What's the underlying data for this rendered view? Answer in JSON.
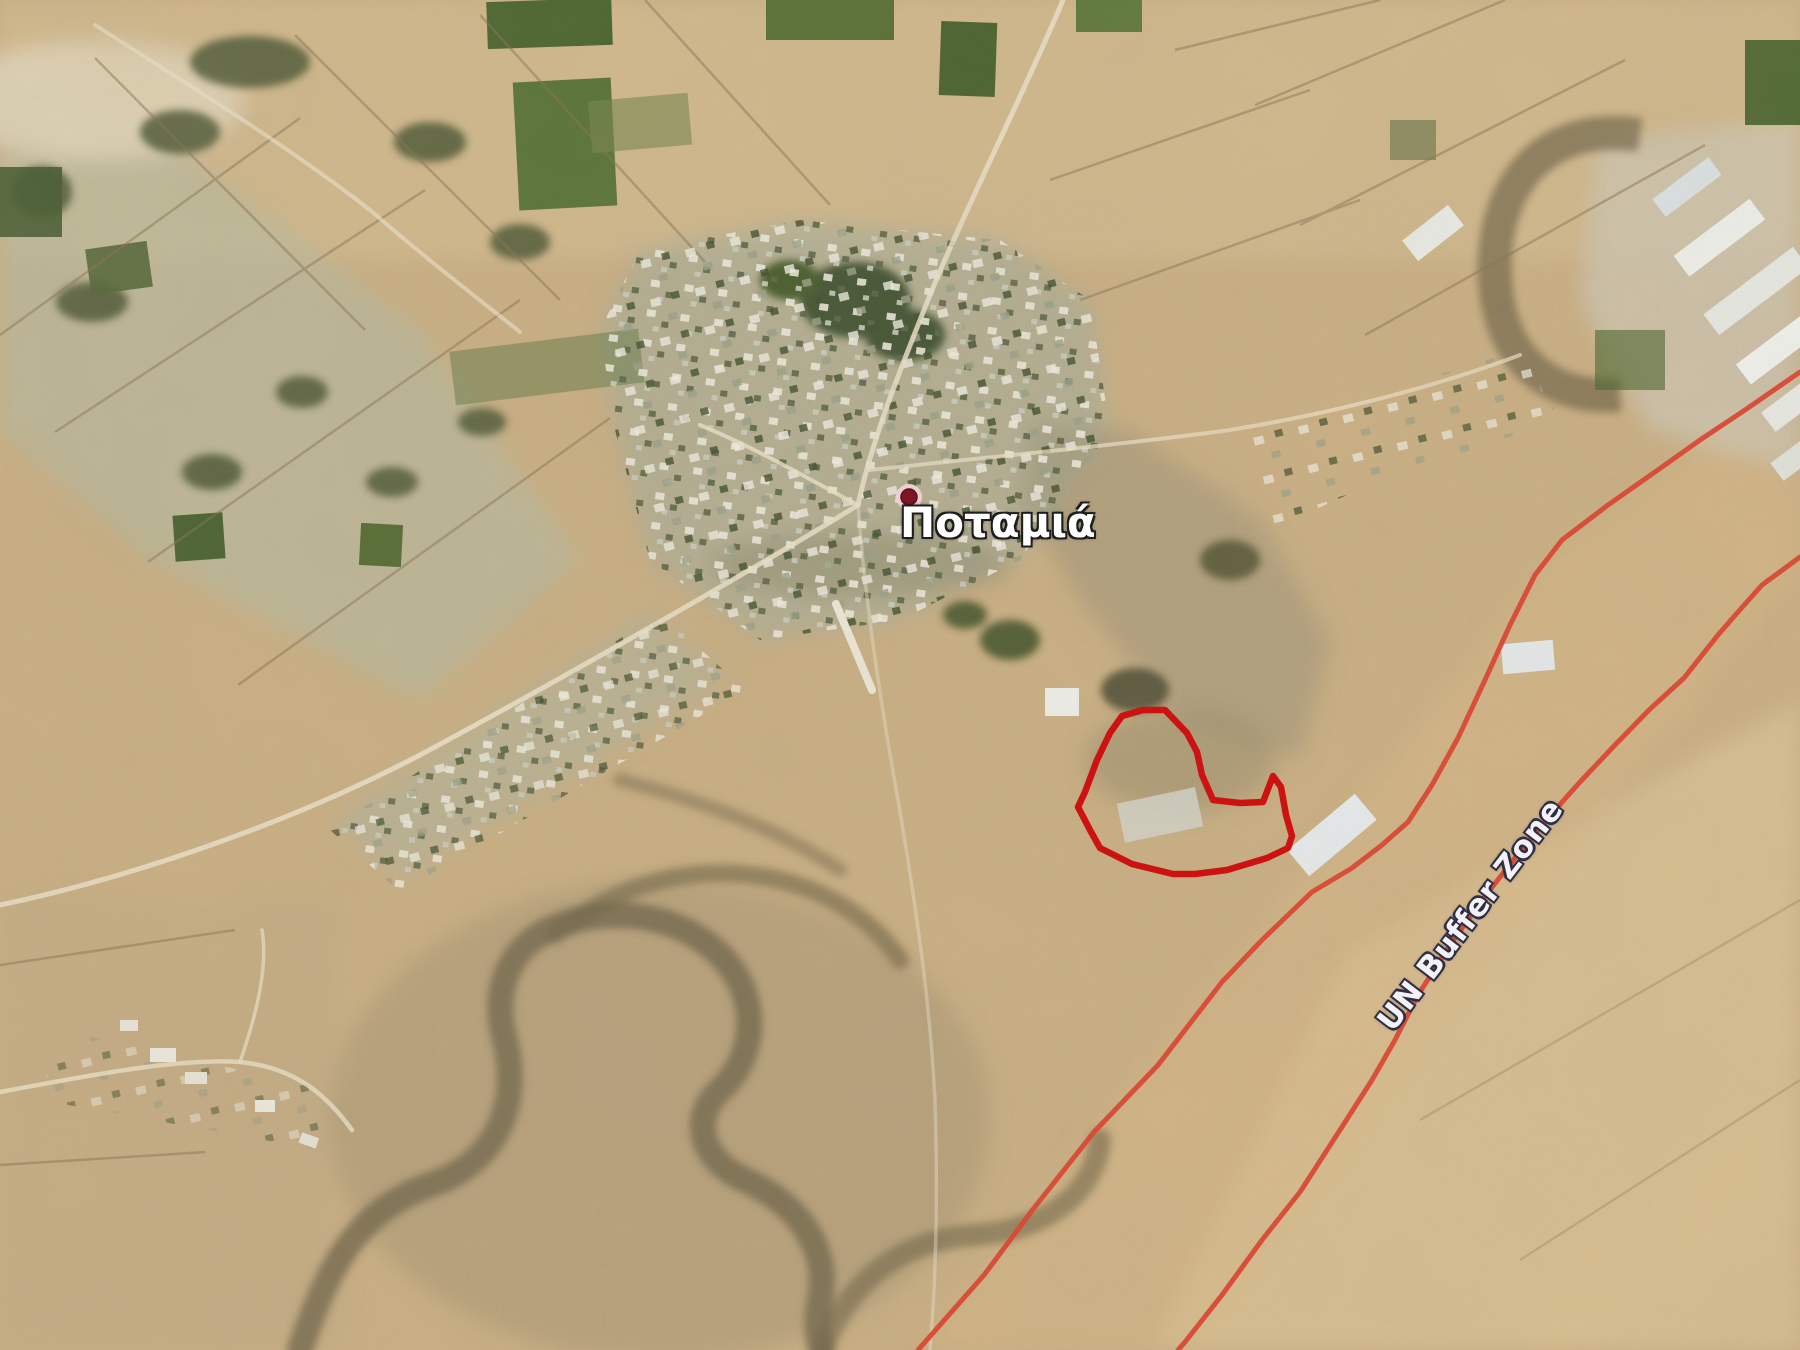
{
  "title": "Satellite map of Potamia village with UN Buffer Zone and red parcel outline",
  "map": {
    "width": 1800,
    "height": 1350,
    "place_marker": {
      "label": "Ποταμιά",
      "x": 909,
      "y": 497,
      "label_x": 900,
      "label_y": 500,
      "label_font_size": 42,
      "dot_radius": 8,
      "dot_ring_radius": 13,
      "dot_color": "#7d1526",
      "dot_ring_color": "#eccfcf",
      "label_color": "#ffffff",
      "label_outline_color": "#1e1e1e"
    },
    "buffer_zone_label": {
      "text": "UN Buffer Zone",
      "x": 1399,
      "y": 1038,
      "rotation_deg": -52.5,
      "font_size": 31,
      "color": "#f2f2f8",
      "outline_color": "#2e2e44"
    },
    "parcel_outline": {
      "color": "#cd1212",
      "stroke_width": 6.5,
      "points": [
        [
          1122,
          716
        ],
        [
          1143,
          710
        ],
        [
          1165,
          710
        ],
        [
          1187,
          733
        ],
        [
          1197,
          752
        ],
        [
          1202,
          775
        ],
        [
          1213,
          800
        ],
        [
          1240,
          803
        ],
        [
          1263,
          802
        ],
        [
          1273,
          776
        ],
        [
          1281,
          787
        ],
        [
          1286,
          815
        ],
        [
          1292,
          836
        ],
        [
          1288,
          848
        ],
        [
          1267,
          858
        ],
        [
          1227,
          870
        ],
        [
          1195,
          874
        ],
        [
          1173,
          874
        ],
        [
          1132,
          864
        ],
        [
          1100,
          848
        ],
        [
          1090,
          830
        ],
        [
          1078,
          807
        ],
        [
          1085,
          792
        ],
        [
          1097,
          760
        ],
        [
          1110,
          733
        ]
      ]
    },
    "boundary_lines": {
      "color": "#d84a36",
      "stroke_width": 5,
      "lines": [
        [
          [
            1800,
            372
          ],
          [
            1745,
            410
          ],
          [
            1700,
            440
          ],
          [
            1655,
            472
          ],
          [
            1608,
            505
          ],
          [
            1562,
            540
          ],
          [
            1535,
            575
          ],
          [
            1510,
            625
          ],
          [
            1485,
            680
          ],
          [
            1458,
            738
          ],
          [
            1432,
            785
          ],
          [
            1408,
            822
          ],
          [
            1382,
            845
          ],
          [
            1352,
            868
          ],
          [
            1312,
            892
          ],
          [
            1262,
            940
          ],
          [
            1222,
            982
          ],
          [
            1158,
            1065
          ],
          [
            1094,
            1132
          ],
          [
            1034,
            1208
          ],
          [
            984,
            1275
          ],
          [
            918,
            1350
          ]
        ],
        [
          [
            1800,
            557
          ],
          [
            1762,
            585
          ],
          [
            1738,
            612
          ],
          [
            1718,
            635
          ],
          [
            1684,
            678
          ],
          [
            1649,
            710
          ],
          [
            1615,
            745
          ],
          [
            1580,
            782
          ],
          [
            1548,
            818
          ],
          [
            1515,
            858
          ],
          [
            1482,
            900
          ],
          [
            1450,
            945
          ],
          [
            1418,
            995
          ],
          [
            1395,
            1040
          ],
          [
            1372,
            1080
          ],
          [
            1340,
            1130
          ],
          [
            1300,
            1192
          ],
          [
            1262,
            1240
          ],
          [
            1222,
            1295
          ],
          [
            1185,
            1342
          ],
          [
            1178,
            1350
          ]
        ]
      ]
    }
  }
}
